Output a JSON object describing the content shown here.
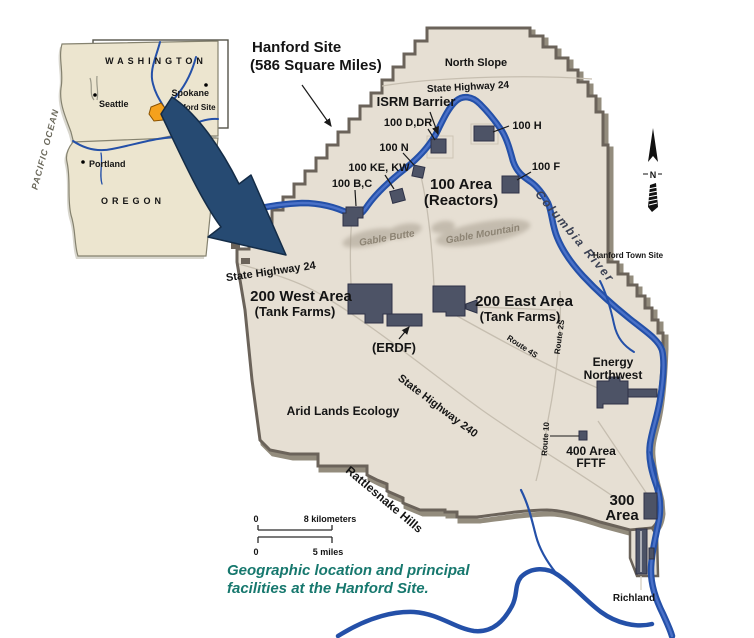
{
  "colors": {
    "land": "#e6dfd3",
    "boundary": "#6b635a",
    "boundary_shadow": "#938c7d",
    "river": "#2450a8",
    "river_highlight": "#4a71c8",
    "building": "#4d5366",
    "road": "#c6beb0",
    "hills": "#a89f90",
    "hills_label": "#8d8474",
    "big_arrow": "#264a72",
    "inset_land": "#ece5cf",
    "marker_orange": "#f5a11c",
    "caption_teal": "#17786e"
  },
  "inset": {
    "state_top": "WASHINGTON",
    "state_bottom": "OREGON",
    "ocean": "PACIFIC OCEAN",
    "city_seattle": "Seattle",
    "city_spokane": "Spokane",
    "city_portland": "Portland",
    "site_marker": "Hanford Site"
  },
  "callout": {
    "line1": "Hanford Site",
    "line2": "(586 Square Miles)"
  },
  "compass": {
    "north": "N"
  },
  "map": {
    "north_slope": "North Slope",
    "hwy24_top": "State Highway 24",
    "hwy24_left": "State Highway 24",
    "isrm": "ISRM Barrier",
    "r100_ddr": "100 D,DR",
    "r100_h": "100 H",
    "r100_n": "100 N",
    "r100_kekw": "100 KE, KW",
    "r100_bc": "100 B,C",
    "r100_f": "100 F",
    "area100_1": "100 Area",
    "area100_2": "(Reactors)",
    "gable_butte": "Gable Butte",
    "gable_mountain": "Gable Mountain",
    "columbia": "Columbia River",
    "town_site": "Hanford Town Site",
    "w200_1": "200 West Area",
    "w200_2": "(Tank Farms)",
    "e200_1": "200 East Area",
    "e200_2": "(Tank Farms)",
    "erdf": "(ERDF)",
    "route4s": "Route 4S",
    "route2s": "Route 2S",
    "route10": "Route 10",
    "energy1": "Energy",
    "energy2": "Northwest",
    "hwy240": "State Highway 240",
    "arid": "Arid Lands Ecology",
    "rattlesnake": "Rattlesnake Hills",
    "area400_1": "400 Area",
    "area400_2": "FFTF",
    "area300_1": "300",
    "area300_2": "Area",
    "richland": "Richland"
  },
  "scalebar": {
    "zero_km": "0",
    "km": "8 kilometers",
    "zero_mi": "0",
    "mi": "5 miles"
  },
  "caption": {
    "line1": "Geographic location and principal",
    "line2": "facilities at the Hanford Site."
  }
}
